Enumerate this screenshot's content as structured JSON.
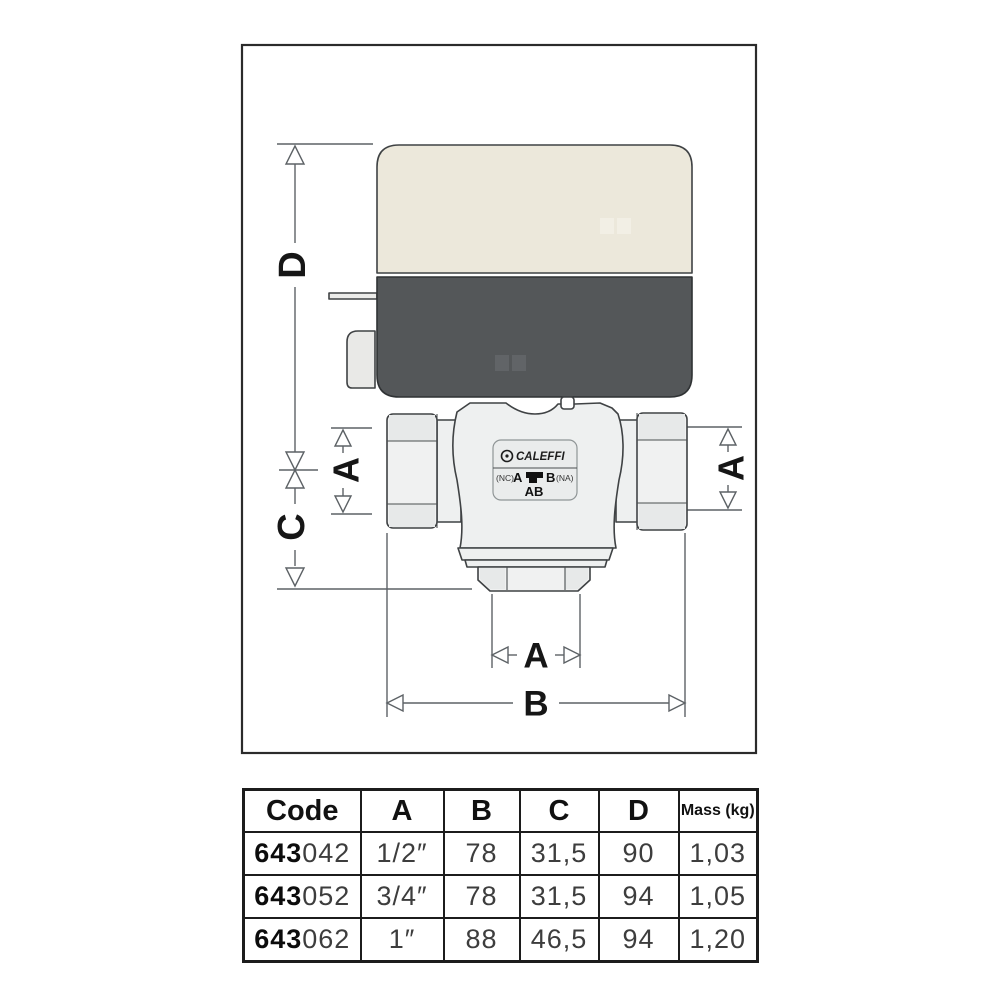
{
  "diagram": {
    "dims": {
      "a": "A",
      "b": "B",
      "c": "C",
      "d": "D"
    },
    "valve_label": {
      "brand": "CALEFFI",
      "nc": "(NC)",
      "port_a": "A",
      "port_b": "B",
      "na": "(NA)",
      "ab": "AB"
    },
    "colors": {
      "actuator_top": "#ece8db",
      "actuator_bottom": "#545759",
      "valve_body": "#eef0f0",
      "dimension_line": "#5d6266",
      "outline": "#3f4244"
    }
  },
  "table": {
    "headers": [
      "Code",
      "A",
      "B",
      "C",
      "D",
      "Mass (kg)"
    ],
    "rows": [
      {
        "code_prefix": "643",
        "code_suffix": "042",
        "a": "1/2″",
        "b": "78",
        "c": "31,5",
        "d": "90",
        "mass": "1,03"
      },
      {
        "code_prefix": "643",
        "code_suffix": "052",
        "a": "3/4″",
        "b": "78",
        "c": "31,5",
        "d": "94",
        "mass": "1,05"
      },
      {
        "code_prefix": "643",
        "code_suffix": "062",
        "a": "1″",
        "b": "88",
        "c": "46,5",
        "d": "94",
        "mass": "1,20"
      }
    ]
  }
}
